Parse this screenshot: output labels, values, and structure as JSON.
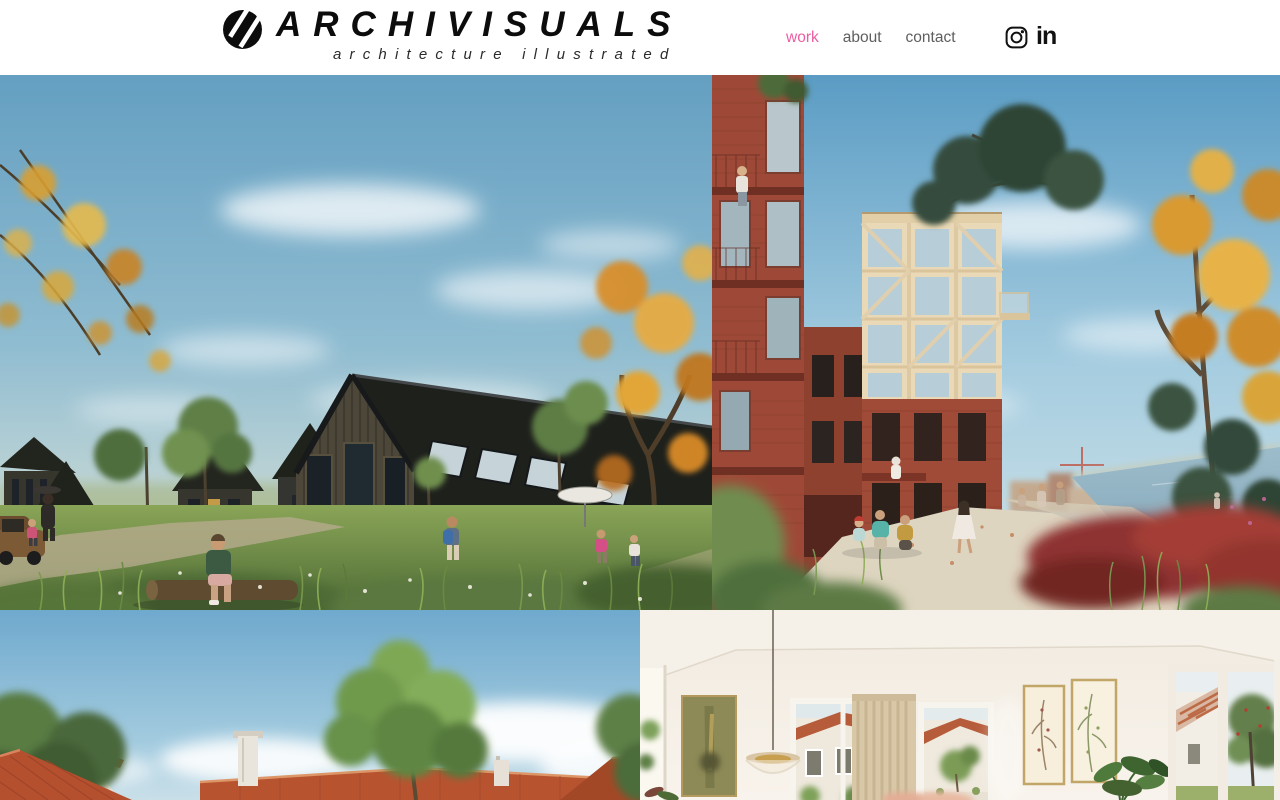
{
  "brand": {
    "name": "ARCHIVISUALS",
    "tagline": "architecture illustrated",
    "logo_icon": "black-circle-double-slash"
  },
  "nav": {
    "items": [
      {
        "label": "work",
        "active": true
      },
      {
        "label": "about",
        "active": false
      },
      {
        "label": "contact",
        "active": false
      }
    ]
  },
  "social": {
    "instagram_icon": "instagram-outline-camera",
    "linkedin_glyph": "in"
  },
  "colors": {
    "accent_pink": "#ec5da2",
    "nav_gray": "#5e5e5e",
    "ink_black": "#0c0c0c",
    "page_background": "#ffffff"
  },
  "gallery": {
    "items": [
      {
        "description": "Black timber gabled houses in a wildflower meadow with children playing and autumn trees"
      },
      {
        "description": "Red brick and timber-frame apartment towers on a planted waterfront promenade"
      },
      {
        "description": "Red clay-tiled rooftops and leafy green trees under a blue sky with clouds"
      },
      {
        "description": "Sun-lit cream living room with garden windows, botanical prints and a glass pendant lamp"
      }
    ]
  }
}
